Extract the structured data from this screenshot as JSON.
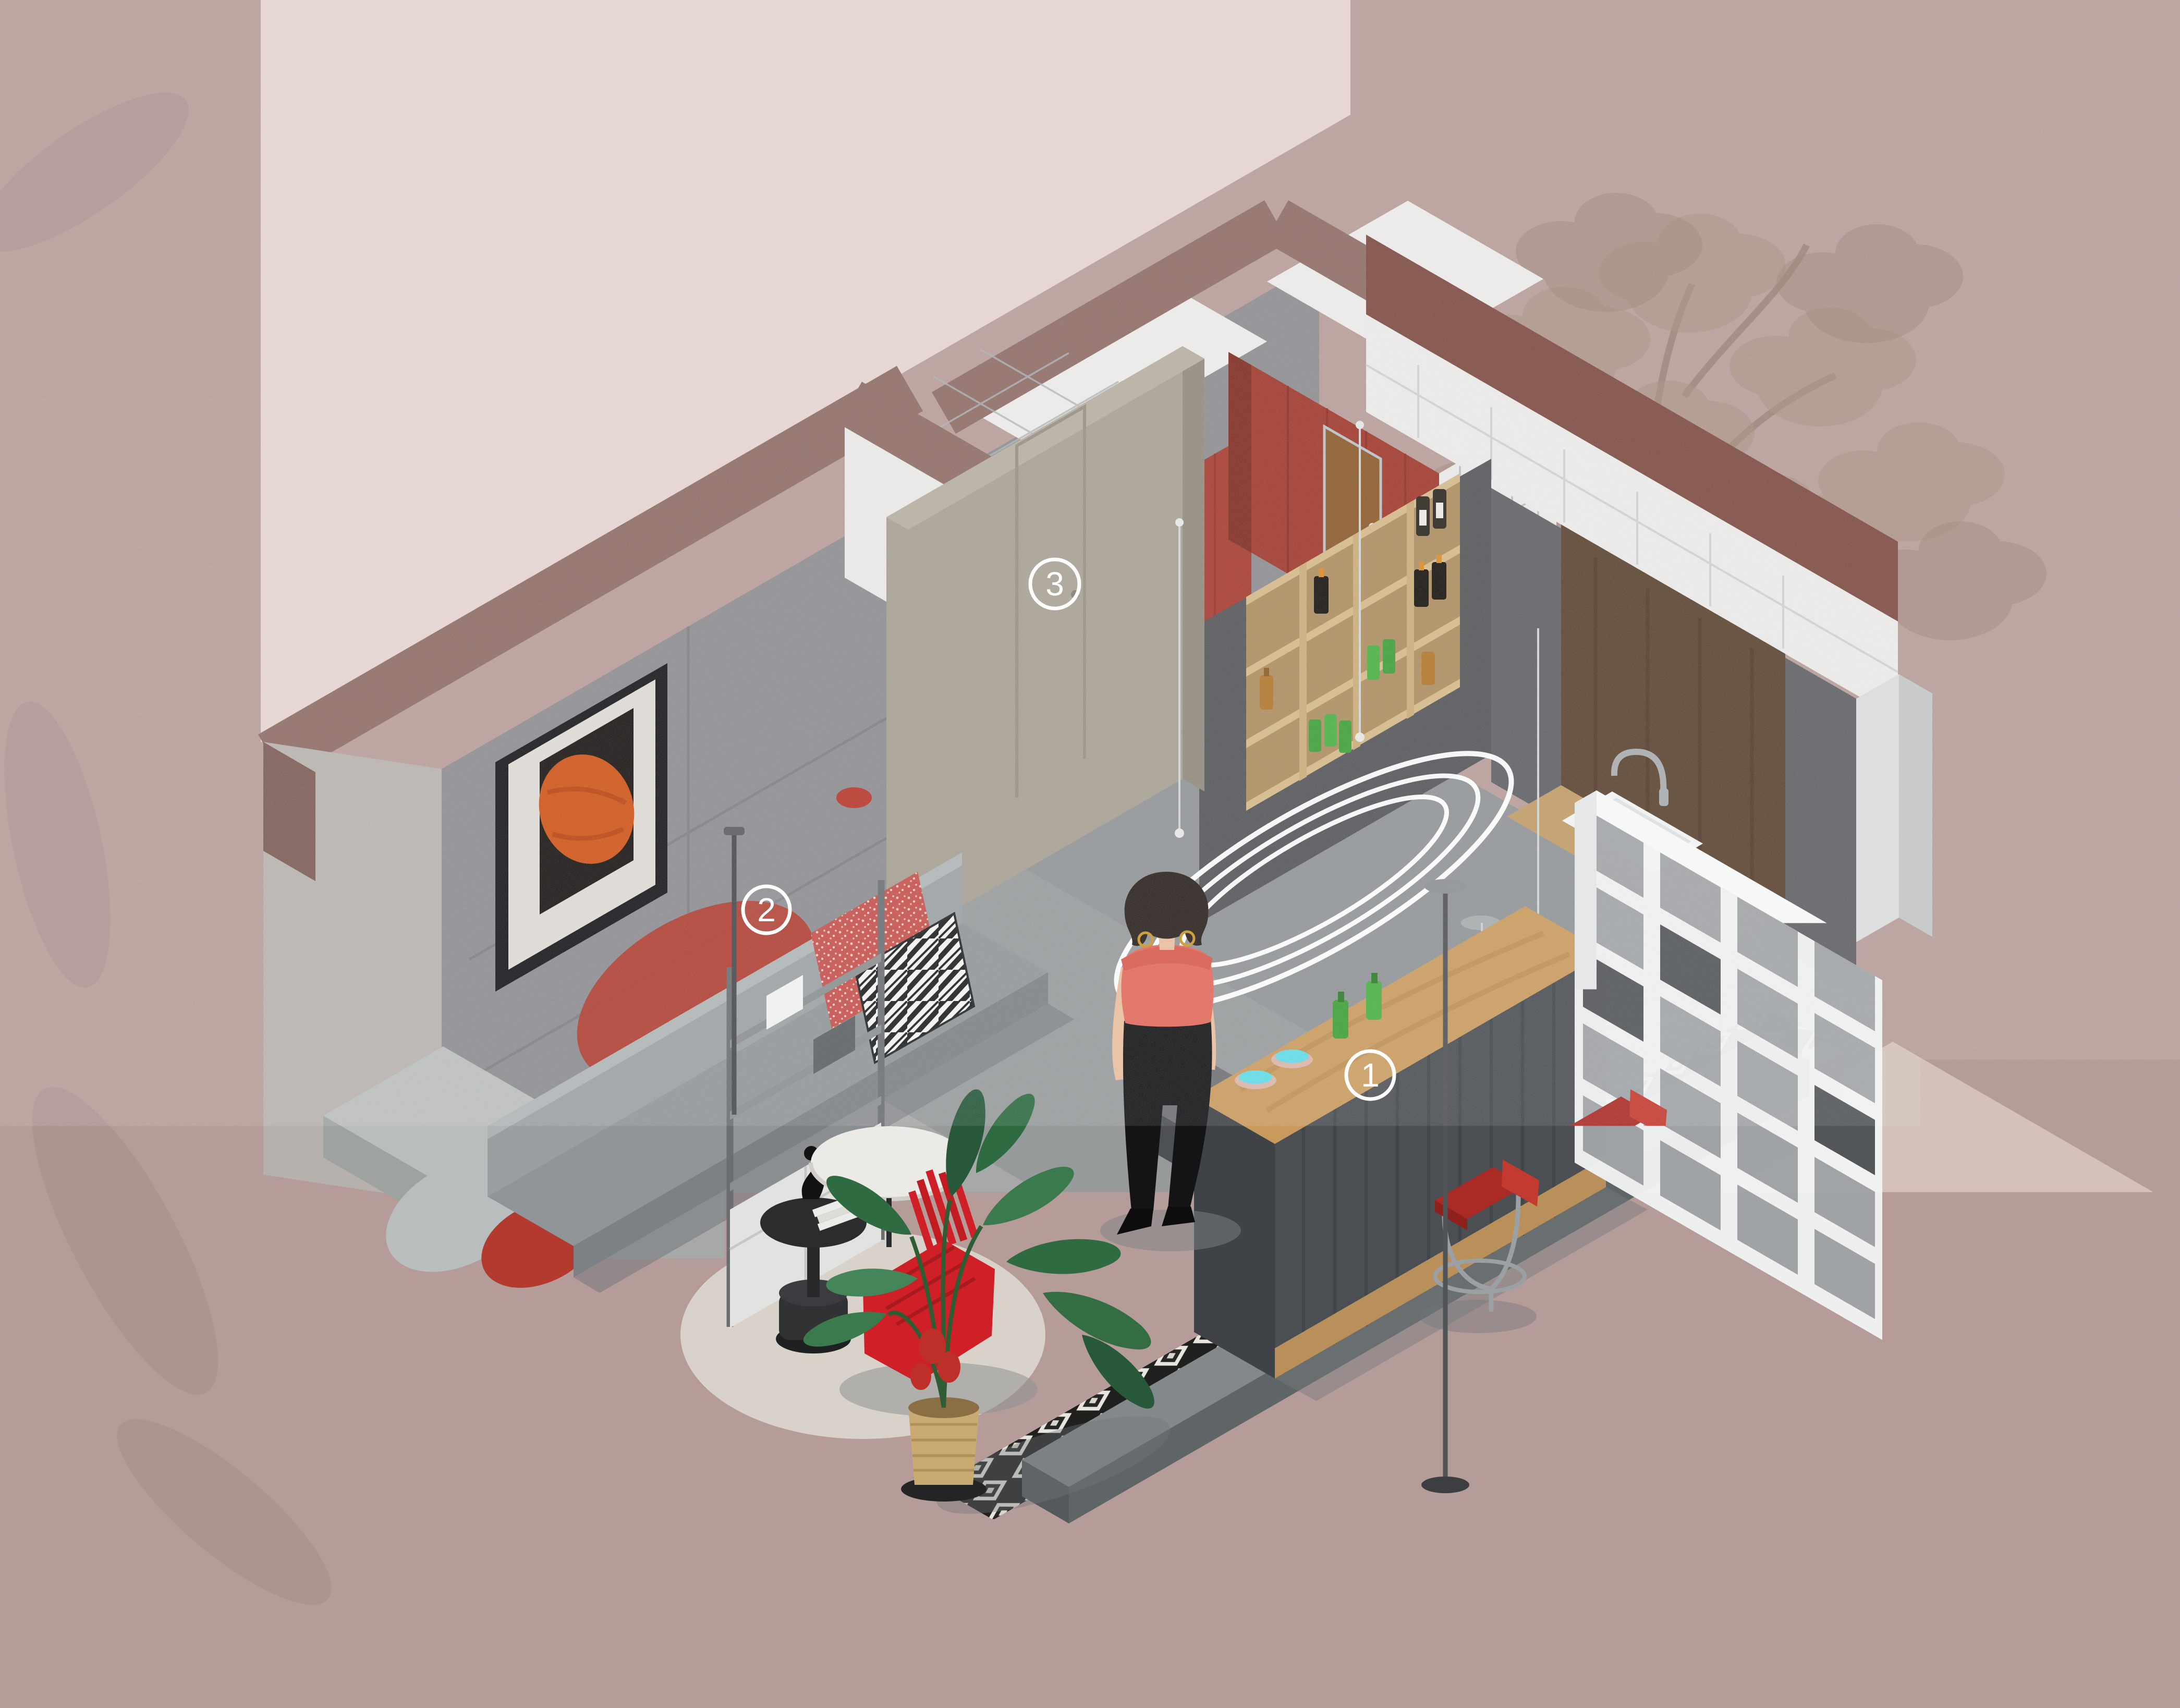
{
  "title": {
    "zh": "聚会乌托邦",
    "en": "Party utopia"
  },
  "legend": {
    "items": [
      {
        "text": "1. 氛围水吧区"
      },
      {
        "text": "2. 观影轰趴区"
      },
      {
        "text": "3. 卫生间"
      }
    ]
  },
  "markers": [
    {
      "number": "1",
      "label": "氛围水吧区"
    },
    {
      "number": "2",
      "label": "观影轰趴区"
    },
    {
      "number": "3",
      "label": "卫生间"
    }
  ],
  "colors": {
    "background_mauve": "#b69c98",
    "light_panel_pink": "#e4d3d0",
    "ground_light": "#d3c1ba",
    "wall_gray": "#8c8c90",
    "wall_dark": "#54555a",
    "wall_band_brown": "#8d6c64",
    "exterior_band_red_brown": "#7c4a41",
    "bathroom_red": "#a53b2f",
    "tile_white": "#e8e7e6",
    "wood_tan": "#c89a5e",
    "shelf_wood": "#c2a173",
    "accent_red": "#c1392d",
    "chair_red": "#ce2026",
    "white_shelf": "#f0f2f2",
    "marker_white": "#ffffff",
    "skin": "#e8bd9d",
    "top_coral": "#e0695c",
    "title_color": "#4e453f",
    "legend_color": "#262322"
  }
}
